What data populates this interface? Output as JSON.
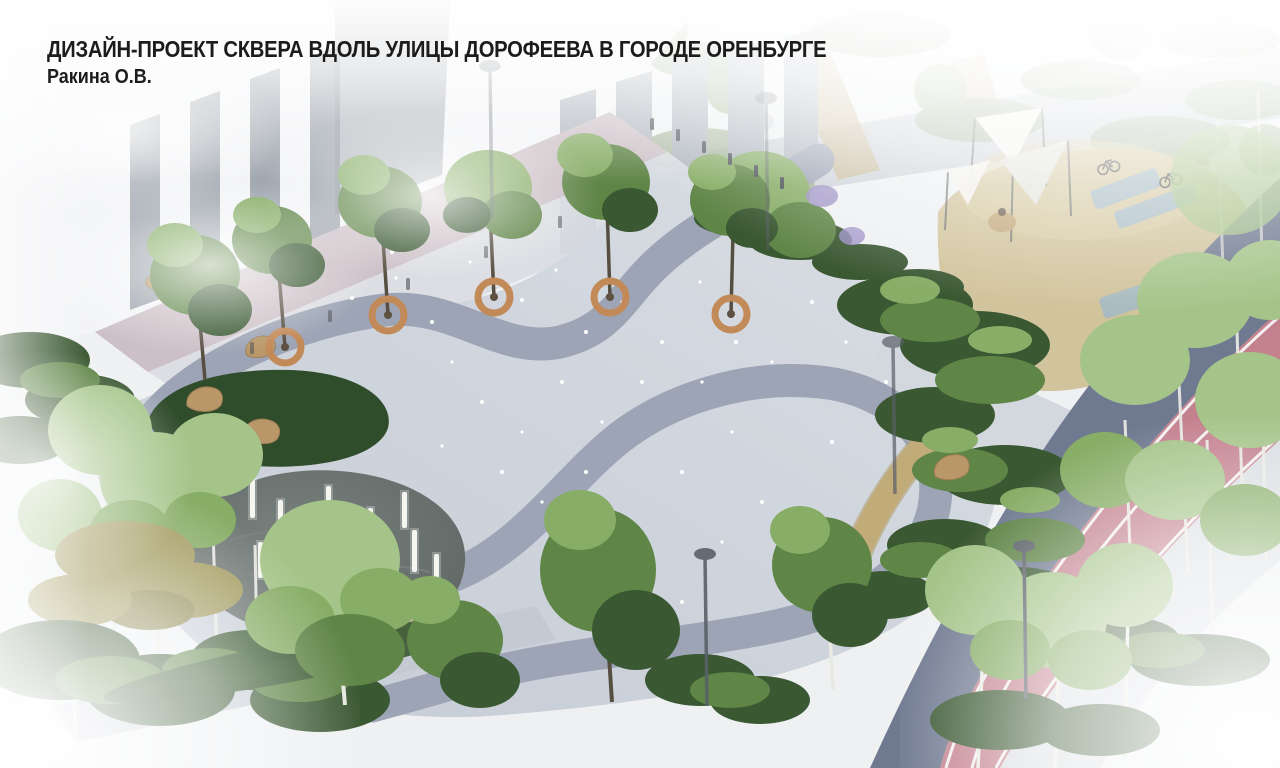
{
  "header": {
    "title": "ДИЗАЙН-ПРОЕКТ СКВЕРА ВДОЛЬ УЛИЦЫ ДОРОФЕЕВА В ГОРОДЕ ОРЕНБУРГЕ",
    "author": "Ракина О.В."
  },
  "colors": {
    "paving": "#ccd2db",
    "band": "#9aa2b4",
    "walkway": "#c3c9d3",
    "walkPink": "#ccc0c6",
    "sidewalkBuilding": "#d9dce1",
    "water": "#656d6b",
    "ripple": "#7e8783",
    "lightColumn": "#f4f6ef",
    "gravel": "#c4b6a1",
    "lawn": "#2f4c2b",
    "foliageDark": "#3a5832",
    "foliageMid": "#5f8547",
    "foliageLight": "#87ad66",
    "birchCanopy": "#a5c489",
    "dryGrass": "#a29a5e",
    "birchTrunk": "#e9e9e3",
    "trunk": "#564f41",
    "benchWood": "#c28a58",
    "sand": "#cfc096",
    "pathTan": "#c1ab79",
    "blueMark": "#9fb9c9",
    "sail": "#f2f1ec",
    "sailShade": "#e3e2da",
    "lilac": "#9b8fc4",
    "road": "#6f7990",
    "bikeLane": "#c3808d",
    "laneLine": "#f7f5f6",
    "sidewalkRight": "#dadde2",
    "building": "#f3f4f6",
    "windowGlass": "#aeb5bd",
    "windowDark": "#8a929b",
    "recess": "#a7adb4",
    "boulder": "#b99768",
    "lamp": "#5a6067",
    "bollard": "#4c5157",
    "twinkle": "#ffffff",
    "title": "#1c1c1c",
    "fog": "#ffffff"
  }
}
